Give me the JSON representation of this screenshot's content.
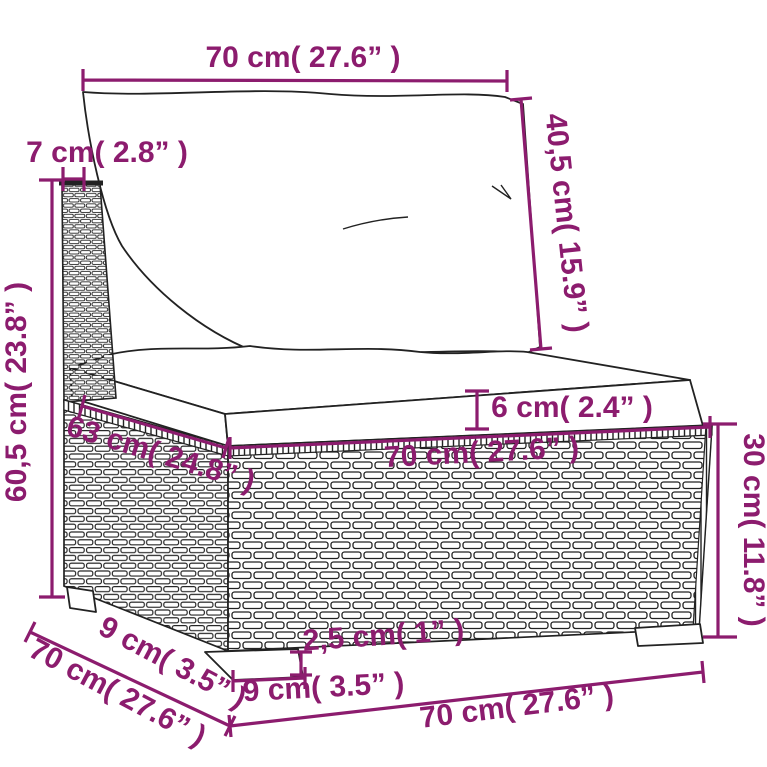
{
  "diagram": {
    "subject": "poly-rattan-sofa-section-dimension-diagram",
    "background": "#ffffff",
    "accent_color": "#8c1c6e",
    "outline_color": "#222222"
  },
  "dims": {
    "top_width": "70 cm( 27.6” )",
    "back_thickness": "7 cm( 2.8” )",
    "back_cushion_height": "40,5 cm( 15.9” )",
    "overall_height": "60,5 cm( 23.8” )",
    "seat_cushion_thickness": "6 cm( 2.4” )",
    "seat_depth": "63 cm( 24.8” )",
    "seat_width": "70 cm( 27.6” )",
    "base_height": "30 cm( 11.8” )",
    "bottom_depth": "70 cm( 27.6” )",
    "foot_depth": "9 cm( 3.5” )",
    "foot_height": "2,5 cm( 1” )",
    "foot_width": "9 cm( 3.5” )",
    "bottom_width": "70 cm( 27.6” )"
  }
}
